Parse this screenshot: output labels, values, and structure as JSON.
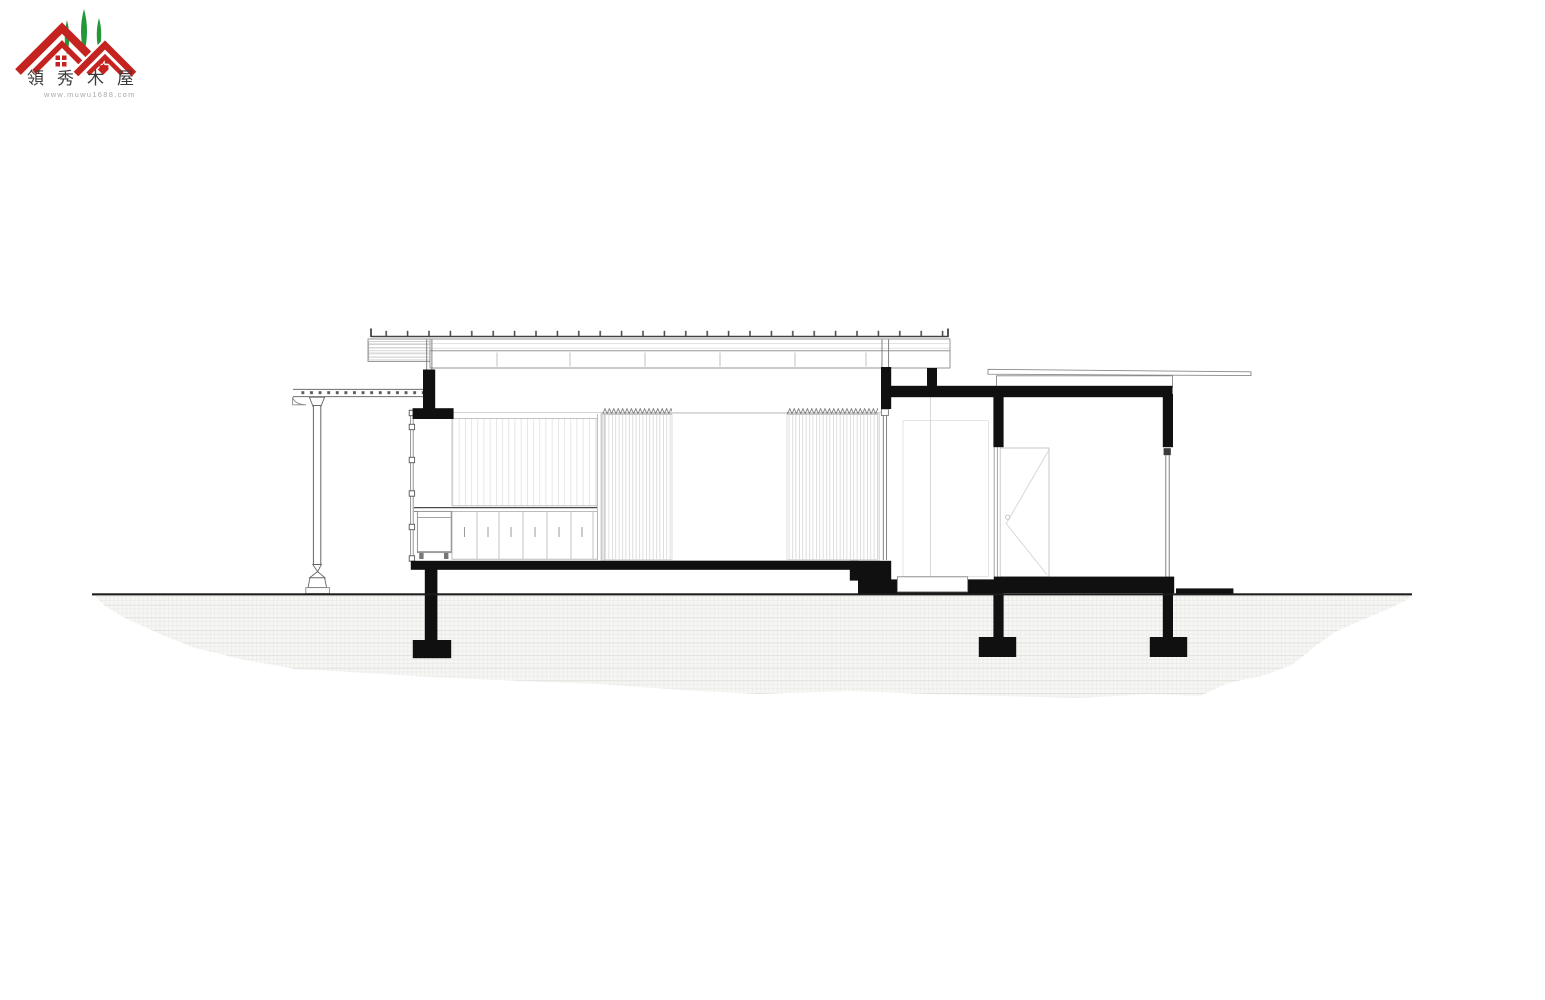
{
  "logo": {
    "brand": "領秀木屋",
    "website": "www.muwu1688.com"
  },
  "colors": {
    "logo_red": "#c5231f",
    "logo_green": "#22983a",
    "ink": "#101010",
    "line_gray": "#8a8a8a",
    "line_light": "#c9c9c9",
    "page_bg": "#ffffff"
  },
  "drawing": {
    "type": "architectural-section",
    "visible_text": []
  }
}
